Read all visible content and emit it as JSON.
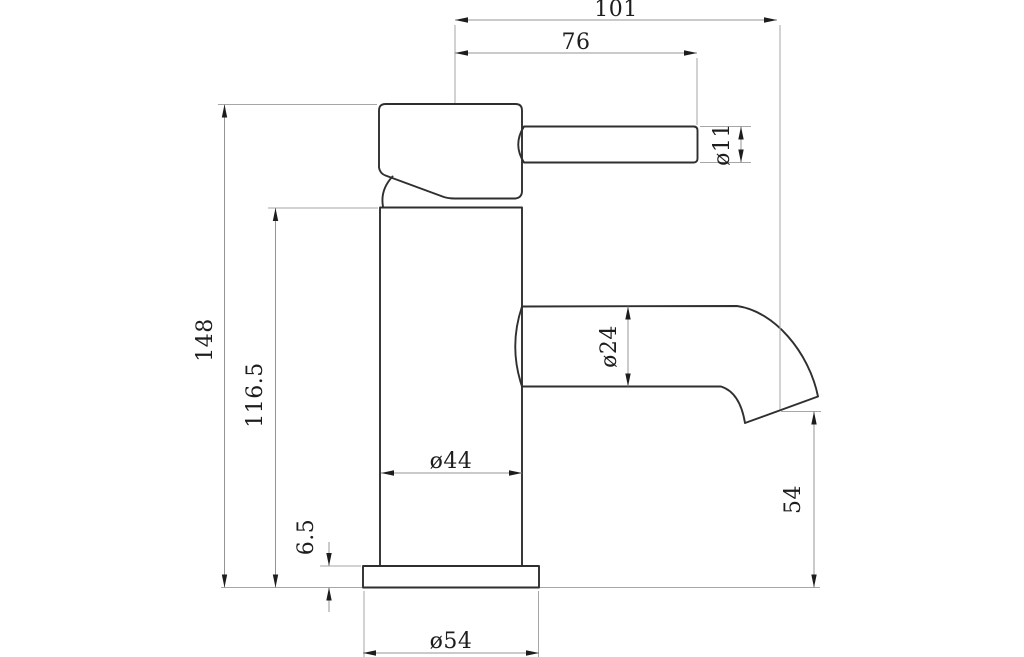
{
  "drawing": {
    "type": "technical-dimension-drawing",
    "subject": "single-lever basin mixer tap, side elevation",
    "units_shown": "",
    "colors": {
      "background": "#ffffff",
      "outline": "#2f2f2f",
      "dimension_line": "#949494",
      "extension_line": "#a6a6a6",
      "arrow": "#1d1d1d",
      "text": "#1d1d1d"
    },
    "labels": {
      "spout_reach_overall": "101",
      "handle_reach": "76",
      "handle_diameter": "ø11",
      "overall_height": "148",
      "body_height": "116.5",
      "spout_diameter": "ø24",
      "body_diameter": "ø44",
      "base_thickness": "6.5",
      "outlet_height": "54",
      "base_diameter": "ø54"
    }
  }
}
